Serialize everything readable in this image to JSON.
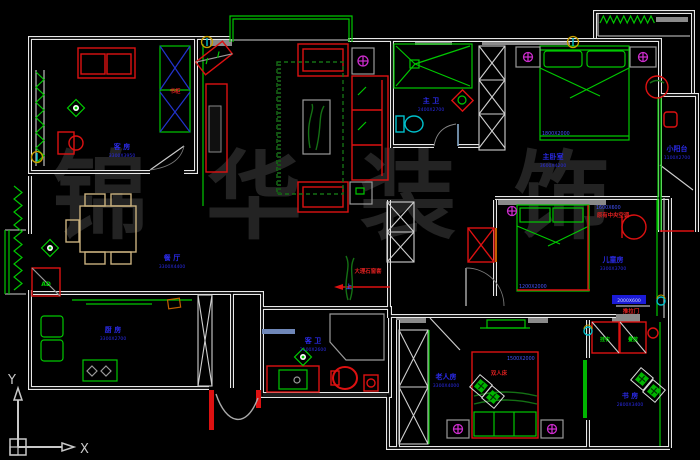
{
  "watermark": "锦华装饰",
  "ucs": {
    "x_label": "X",
    "y_label": "Y"
  },
  "rooms": {
    "guest": {
      "name": "客 房",
      "dim": "3300X3950"
    },
    "dining": {
      "name": "餐 厅",
      "dim": "3300X4400"
    },
    "kitchen": {
      "name": "厨 房",
      "dim": "3300X2700"
    },
    "guest_bath": {
      "name": "客 卫",
      "dim": "2100X2600"
    },
    "master_bath": {
      "name": "主 卫",
      "dim": "2400X2700"
    },
    "master": {
      "name": "主卧室",
      "dim": "3600X4200"
    },
    "small_balcony": {
      "name": "小阳台",
      "dim": "1100X2700"
    },
    "children": {
      "name": "儿童房",
      "dim": "3300X3700"
    },
    "elder": {
      "name": "老人房",
      "dim": "3300X4000"
    },
    "study": {
      "name": "书 房",
      "dim": "2800X3400"
    }
  },
  "annotations": {
    "bookshelf": "书柜",
    "double_bed": "双人床",
    "dim_master_bed": "1800X2000",
    "dim_child_bed": "1200X2000",
    "dim_elder_bed": "1500X2000",
    "marble_sill": "大理石窗套",
    "up": "上",
    "central_ac": "原有中央空调",
    "ac_dim": "1600X600",
    "slide_tag": "2000X600",
    "slide_door": "推拉门",
    "air_duct": "AD",
    "hang": "挂衣",
    "fold": "叠放"
  },
  "palette": {
    "background": "#000000",
    "wall": "#e8e8e8",
    "green": "#00c800",
    "red": "#dd1111",
    "blue_label": "#2a2ae6",
    "dim_blue": "#4455ff",
    "cyan": "#00c0cc",
    "magenta": "#cc2ccc",
    "yellow": "#c8a000",
    "tan": "#c9b07e",
    "watermark": "#232323"
  }
}
